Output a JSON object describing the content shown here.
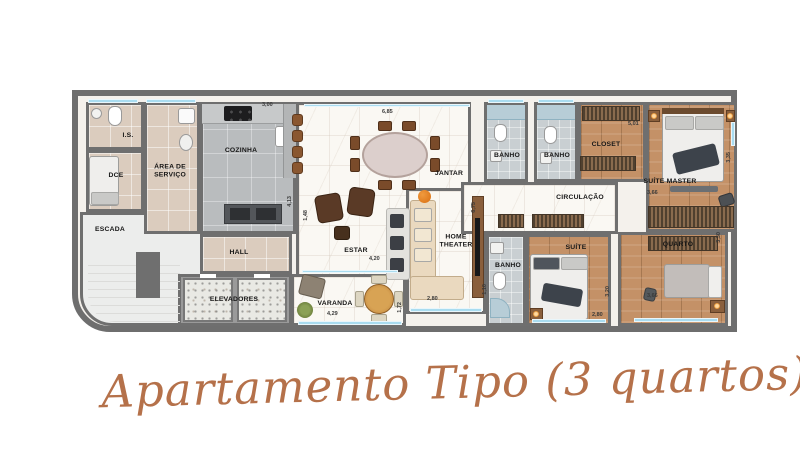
{
  "caption": "Apartamento Tipo (3 quartos)",
  "colors": {
    "wall": "#6e6e6e",
    "window": "#a9dcf0",
    "wood_floor": "#c49167",
    "marble_floor": "#faf8f3",
    "script_accent": "#b5714a"
  },
  "rooms": [
    {
      "label": "I.S."
    },
    {
      "label": "DCE"
    },
    {
      "label": "ÁREA DE SERVIÇO"
    },
    {
      "label": "COZINHA"
    },
    {
      "label": "ESCADA"
    },
    {
      "label": "HALL"
    },
    {
      "label": "ELEVADORES"
    },
    {
      "label": "ESTAR"
    },
    {
      "label": "JANTAR"
    },
    {
      "label": "VARANDA"
    },
    {
      "label": "HOME THEATER"
    },
    {
      "label": "BANHO"
    },
    {
      "label": "BANHO"
    },
    {
      "label": "CLOSET"
    },
    {
      "label": "SUÍTE MASTER"
    },
    {
      "label": "CIRCULAÇÃO"
    },
    {
      "label": "BANHO"
    },
    {
      "label": "SUÍTE"
    },
    {
      "label": "QUARTO"
    }
  ],
  "dimensions": [
    {
      "value": "3,00"
    },
    {
      "value": "6,85"
    },
    {
      "value": "4,13"
    },
    {
      "value": "1,48"
    },
    {
      "value": "4,20"
    },
    {
      "value": "4,29"
    },
    {
      "value": "1,72"
    },
    {
      "value": "6,75"
    },
    {
      "value": "2,80"
    },
    {
      "value": "1,10"
    },
    {
      "value": "2,80"
    },
    {
      "value": "3,20"
    },
    {
      "value": "3,66"
    },
    {
      "value": "3,30"
    },
    {
      "value": "3,66"
    },
    {
      "value": "3,35"
    },
    {
      "value": "5,01"
    }
  ]
}
